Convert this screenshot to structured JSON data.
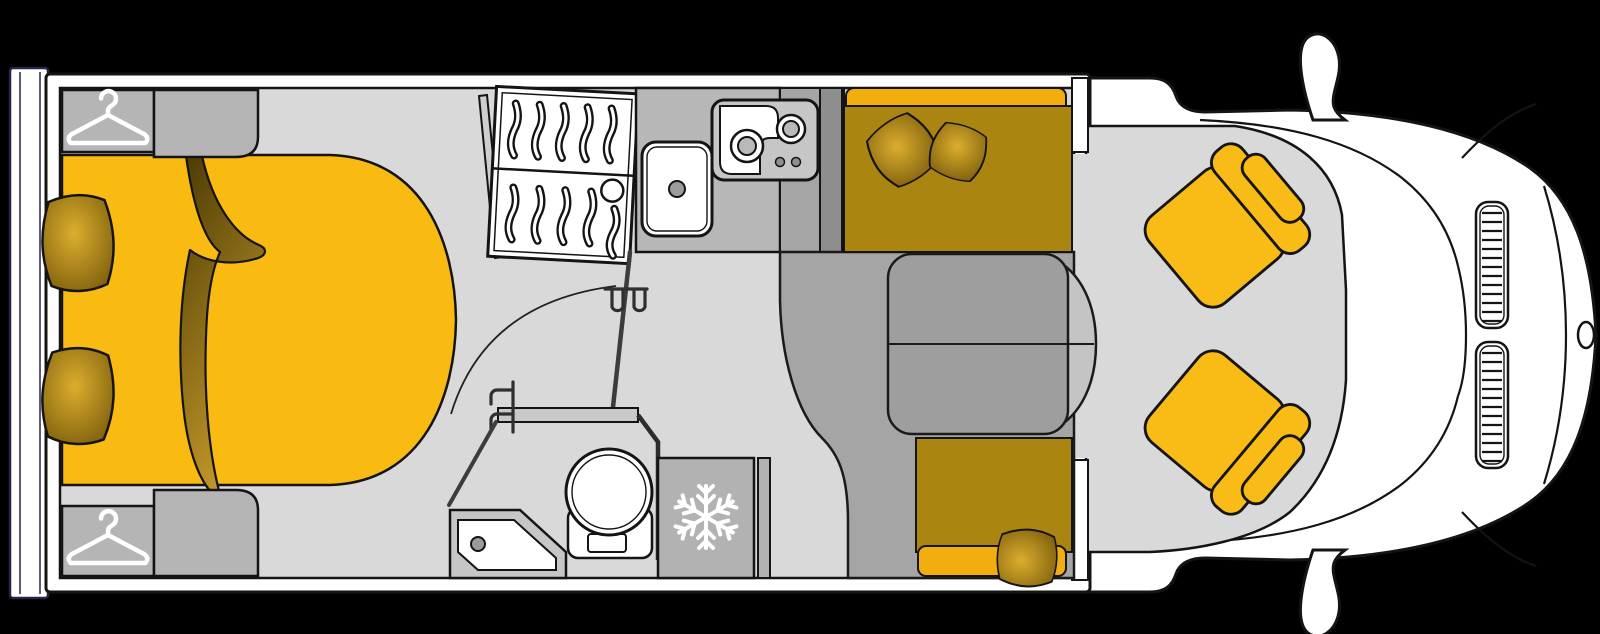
{
  "scene": {
    "type": "motorhome-floorplan-top-view",
    "background": "#000000"
  },
  "colors": {
    "outline": "#141414",
    "body_white": "#ffffff",
    "rear_trim": "#23234d",
    "wall": "#ffffff",
    "floor": "#d9d9d9",
    "cabinet": "#b5b5b5",
    "counter": "#b7b7b7",
    "counter_dark": "#a5a5a5",
    "pillar": "#8e8e8e",
    "platform": "#a5a5a5",
    "fridge": "#b2b2b2",
    "table": "#9e9e9e",
    "table_leaf": "#c4c4c4",
    "tray": "#c6c6c6",
    "tray_inner": "#ffffff",
    "bed": "#f9ba12",
    "bench_shaded": "#ab8511",
    "bench_bright": "#f2ae0e",
    "seat": "#f9bc16",
    "pillow_dark": "#77590a",
    "pillow_light": "#dcae2e",
    "blanket_dark": "#4f3d05",
    "blanket_light": "#c69a2a",
    "hob_panel": "#c6c6c6",
    "burner_inner": "#b9b9b9",
    "drain": "#9a9a9a",
    "door": "#3c3c3c",
    "handle": "#2f2f2f",
    "icon": "#ffffff"
  },
  "icons": {
    "wardrobe": "hanger-icon",
    "fridge": "snowflake-icon"
  },
  "fixtures": {
    "bedroom": "island-bed-with-wardrobes",
    "washroom": "shower-toilet-swing-door",
    "kitchen": "sink-and-two-burner-hob",
    "lounge": "face-to-face-dinette-with-table",
    "cab": "two-swivel-seats",
    "vehicle": "front-cab-with-mirrors-grille-badge"
  }
}
